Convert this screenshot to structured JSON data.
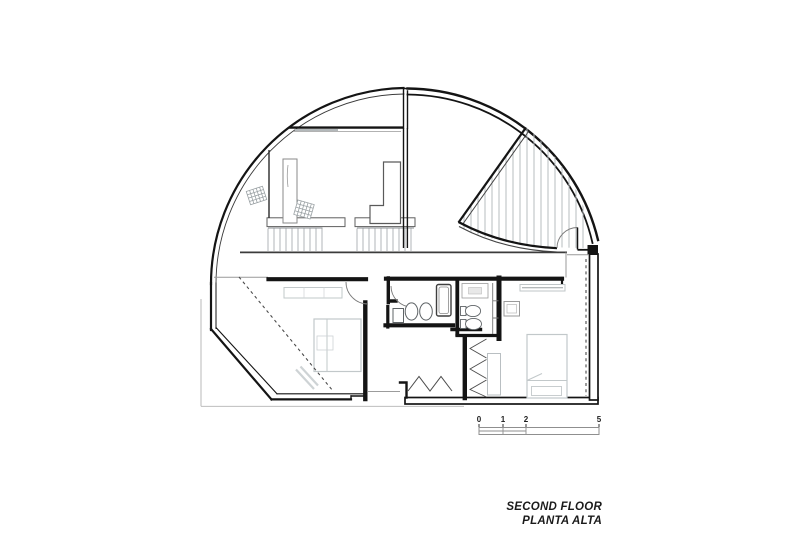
{
  "title_block": {
    "line1": "SECOND FLOOR",
    "line2": "PLANTA ALTA"
  },
  "scale_bar": {
    "labels": [
      "0",
      "1",
      "2",
      "5"
    ]
  },
  "colors": {
    "wall": "#141414",
    "thin_line": "#8a8a8a",
    "furniture": "#c2c8ca",
    "stair_hatch": "#a9aeb1",
    "terrace_hatch": "#b7bcbf",
    "dashed_line": "#4a4a4a",
    "background": "#ffffff"
  }
}
